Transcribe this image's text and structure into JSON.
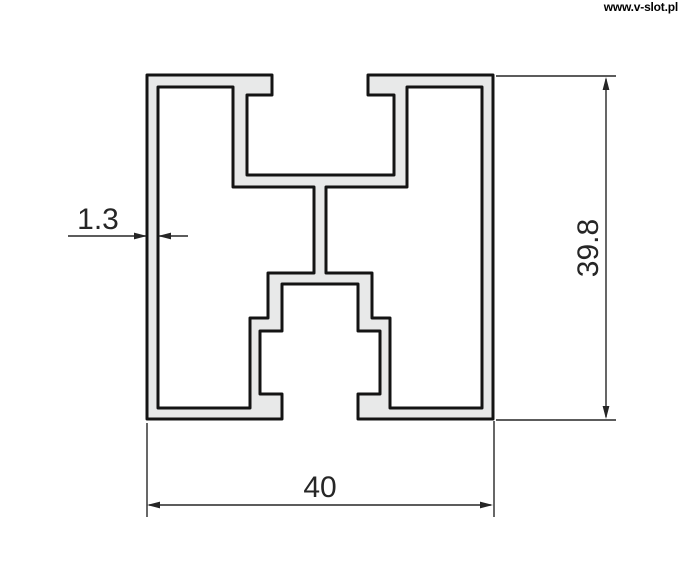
{
  "watermark": {
    "text": "www.v-slot.pl"
  },
  "profile": {
    "description": "aluminium-extrusion-cross-section",
    "fill_color": "#e8e9e9",
    "outline_color": "#141414",
    "path": "M147,75 H272 V95 H247 V175 H394 V95 H368 V75 H493 V419 H358 V394 H380 V331 H358 V284 H282 V331 H260 V394 H282 V419 H147 Z M158,87 H233 V187 H314 V273 H268 V318 H250 V408 H158 Z M407,87 H482 V408 H390 V318 H372 V273 H326 V187 H407 Z",
    "dimensions_mm": {
      "width": 40,
      "height": 39.8,
      "wall_thickness": 1.3
    }
  },
  "dimensions": {
    "wall_thickness": {
      "label": "1.3"
    },
    "height": {
      "label": "39.8"
    },
    "width": {
      "label": "40"
    }
  },
  "dim_style": {
    "line_color": "#262626",
    "text_color": "#262626"
  }
}
